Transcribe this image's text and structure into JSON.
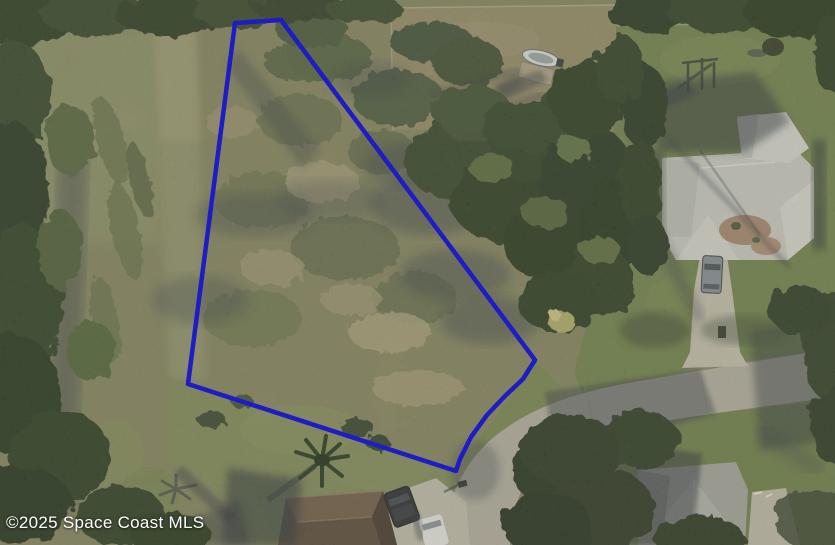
{
  "watermark": {
    "text": "©2025 Space Coast MLS",
    "color": "#ffffff",
    "font_size_px": 17
  },
  "parcel_outline": {
    "points": "235,23 281,20 535,360 523,379 505,396 487,415 471,437 460,459 456,471 188,384",
    "stroke_color": "#1e1cc4",
    "stroke_width": 4.5
  },
  "palette": {
    "scrub_base": "#8d8b68",
    "lawn": "#71864b",
    "lawn_south": "#87925e",
    "dry_field": "#a39573",
    "road": "#b5b1a5",
    "tree_dark": "#31402b",
    "shadow": "#39414f",
    "roof_east": "#cbccc7",
    "roof_south": "#5e4e42",
    "roof_southeast": "#a6a7a1",
    "driveway": "#c6c1b1"
  },
  "scene_objects": [
    "outlined-vacant-brush-lot",
    "tree-line-west",
    "tree-line-north",
    "dry-field-north",
    "boat-and-shed",
    "house-east-gray-roof",
    "house-south-brown-roof",
    "house-southeast-gray-roof",
    "curving-street",
    "driveway-east-with-car",
    "driveway-south-with-suv-and-white-car",
    "palm-tree",
    "lawns-and-tree-shadows",
    "white-building-northwest"
  ]
}
